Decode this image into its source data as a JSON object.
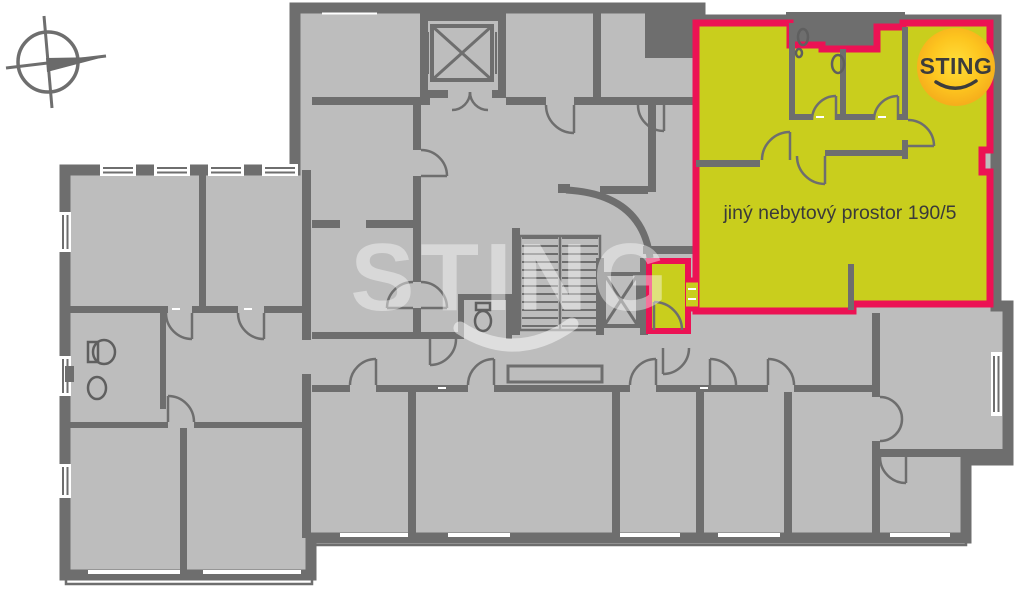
{
  "unit": {
    "label": "jiný nebytový prostor 190/5",
    "fill_color": "#c9ce1d",
    "border_color": "#ec1254"
  },
  "branding": {
    "logo_text": "STING",
    "watermark_text": "STING",
    "logo_circle_inner_color": "#ffd83a",
    "logo_circle_outer_color": "#f4a81b",
    "logo_text_color": "#3c3c3c"
  },
  "plan": {
    "wall_color": "#6e6e6e",
    "floor_color": "#bdbdbd",
    "background_color": "#ffffff"
  },
  "icons": {
    "compass": "compass-rose",
    "stairs": "staircase",
    "elevator": "elevator-shaft-x",
    "smile": "smile-curve"
  }
}
